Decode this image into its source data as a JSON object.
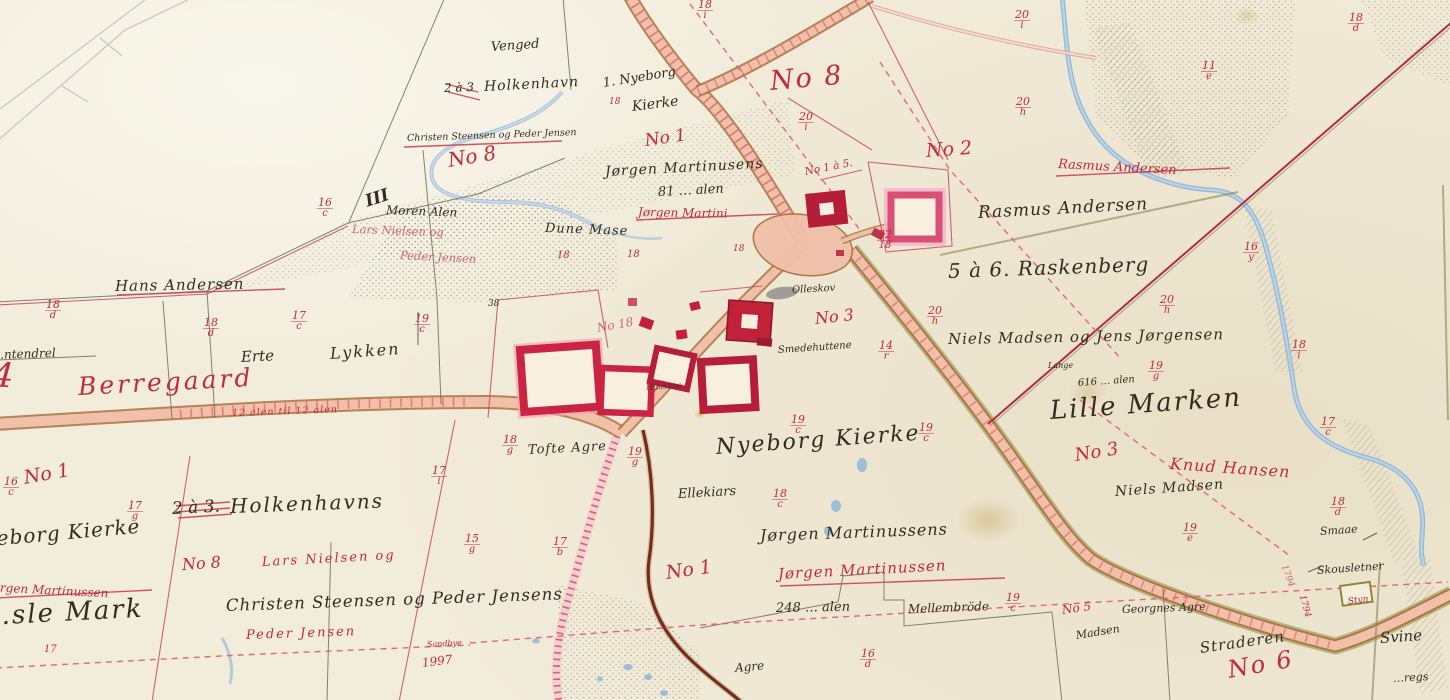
{
  "paper": {
    "bg": "#f2ecdb",
    "ink": "#332c22",
    "red": "#c22a3d",
    "road": "#f1c0a8",
    "water": "#8fb6d8"
  },
  "names": {
    "venged": "Venged",
    "two_three_top": "2 à 3",
    "holkenhavn_top": "Holkenhavn",
    "nyeborg_line1": "1. Nyeborg",
    "nyeborg_line2": "Kierke",
    "christen_small": "Christen Steensen og Peder Jensen",
    "jorgen_martinusens": "Jørgen Martinusens",
    "alen_81": "81 … alen",
    "moren_alen": "Moren Alen",
    "iii": "III",
    "dune_mase": "Dune Mase",
    "hans_andersen": "Hans Andersen",
    "tendrel": "…ntendrel",
    "erte": "Erte",
    "lykken": "Lykken",
    "rasmus_andersen": "Rasmus Andersen",
    "raskenberg": "5 à 6. Raskenberg",
    "niels_madsen_jens": "Niels Madsen og Jens Jørgensen",
    "lange": "Lange",
    "alen_616": "616 … alen",
    "lille_marken": "Lille Marken",
    "niels_madsen": "Niels Madsen",
    "smaae": "Smaae",
    "skousletner": "Skousletner",
    "nyeborg_big": "Nyeborg Kierke",
    "ellekiars": "Ellekiars",
    "jorgen_martinussens": "Jørgen Martinussens",
    "alen_248": "248 … alen",
    "mellembrode": "Mellembröde",
    "agre": "Agre",
    "tofte_agre": "Tofte Agre",
    "two_three_big": "2 à 3.",
    "holkenhavns": "Holkenhavns",
    "nyeborg_left": "Nyeborg Kierke",
    "sle_mark": "…sle Mark",
    "christen_big": "Christen Steensen og Peder Jensens",
    "straderen": "Straderen",
    "svine": "Svine",
    "regs": "…regs",
    "georgnes_agre": "Georgnes Agre",
    "madsen": "Madsen",
    "olleskov": "Olleskov",
    "smedehuttene": "Smedehuttene",
    "huusene": "Huusene",
    "n38": "38"
  },
  "red": {
    "four": "4",
    "berregaard": "Berregaard",
    "no8_top": "No 8",
    "no2": "No 2",
    "rasmus_struck": "Rasmus Andersen",
    "no1_top": "No 1",
    "no1a5": "No 1 à 5.",
    "no3_village": "No 3",
    "no18": "No 18",
    "no8_mid": "No 8",
    "no1_left": "No 1",
    "no8_bl": "No 8",
    "lars_nielsen": "Lars Nielsen og",
    "lars_mid": "Lars Nielsen og",
    "peder_mid": "Peder Jensen",
    "peder_jensen": "Peder Jensen",
    "sandbye": "Sandbye",
    "jorgen_left": "Jørgen Martinussen",
    "jorgen_mid": "Jørgen Martini",
    "no1_bottom": "No 1",
    "jorgen_bottom": "Jørgen Martinussen",
    "no3_lille": "No 3",
    "knud_hansen": "Knud Hansen",
    "no5": "No 5",
    "no6": "No 6",
    "y1997": "1997",
    "y1794": "1794",
    "styn": "Styn",
    "road_alen": "12 alen til 12 alen",
    "s18a": "18",
    "s18b": "18",
    "s18c": "18",
    "s18d": "18"
  },
  "fr": {
    "f1": {
      "n": "18",
      "d": "d"
    },
    "f2": {
      "n": "18",
      "d": "d"
    },
    "f3": {
      "n": "17",
      "d": "c"
    },
    "f4": {
      "n": "19",
      "d": "c"
    },
    "f5": {
      "n": "16",
      "d": "c"
    },
    "f6": {
      "n": "16",
      "d": "c"
    },
    "f7": {
      "n": "17",
      "d": "g"
    },
    "f8": {
      "n": "17",
      "d": "i"
    },
    "f9": {
      "n": "15",
      "d": "g"
    },
    "f10": {
      "n": "17",
      "d": "b"
    },
    "f11": {
      "n": "18",
      "d": "g"
    },
    "f12": {
      "n": "19",
      "d": "g"
    },
    "f13": {
      "n": "19",
      "d": "c"
    },
    "f14": {
      "n": "19",
      "d": "c"
    },
    "f15": {
      "n": "18",
      "d": "c"
    },
    "f16": {
      "n": "20",
      "d": "i"
    },
    "f17": {
      "n": "18",
      "d": "i"
    },
    "f18": {
      "n": "20",
      "d": "i"
    },
    "f19": {
      "n": "20",
      "d": "h"
    },
    "f20": {
      "n": "20",
      "d": "h"
    },
    "f21": {
      "n": "20",
      "d": "h"
    },
    "f22": {
      "n": "16",
      "d": "y"
    },
    "f23": {
      "n": "18",
      "d": "i"
    },
    "f24": {
      "n": "17",
      "d": "c"
    },
    "f25": {
      "n": "18",
      "d": "d"
    },
    "f26": {
      "n": "19",
      "d": "e"
    },
    "f27": {
      "n": "18",
      "d": "d"
    },
    "f28": {
      "n": "11",
      "d": "e"
    },
    "f29": {
      "n": "16",
      "d": "d"
    },
    "f30": {
      "n": "22",
      "d": "18"
    },
    "f31": {
      "n": "14",
      "d": "r"
    },
    "f32": {
      "n": "19",
      "d": "g"
    },
    "f33": {
      "n": "19",
      "d": "c"
    },
    "f34": {
      "n": "17",
      "d": "r"
    }
  }
}
